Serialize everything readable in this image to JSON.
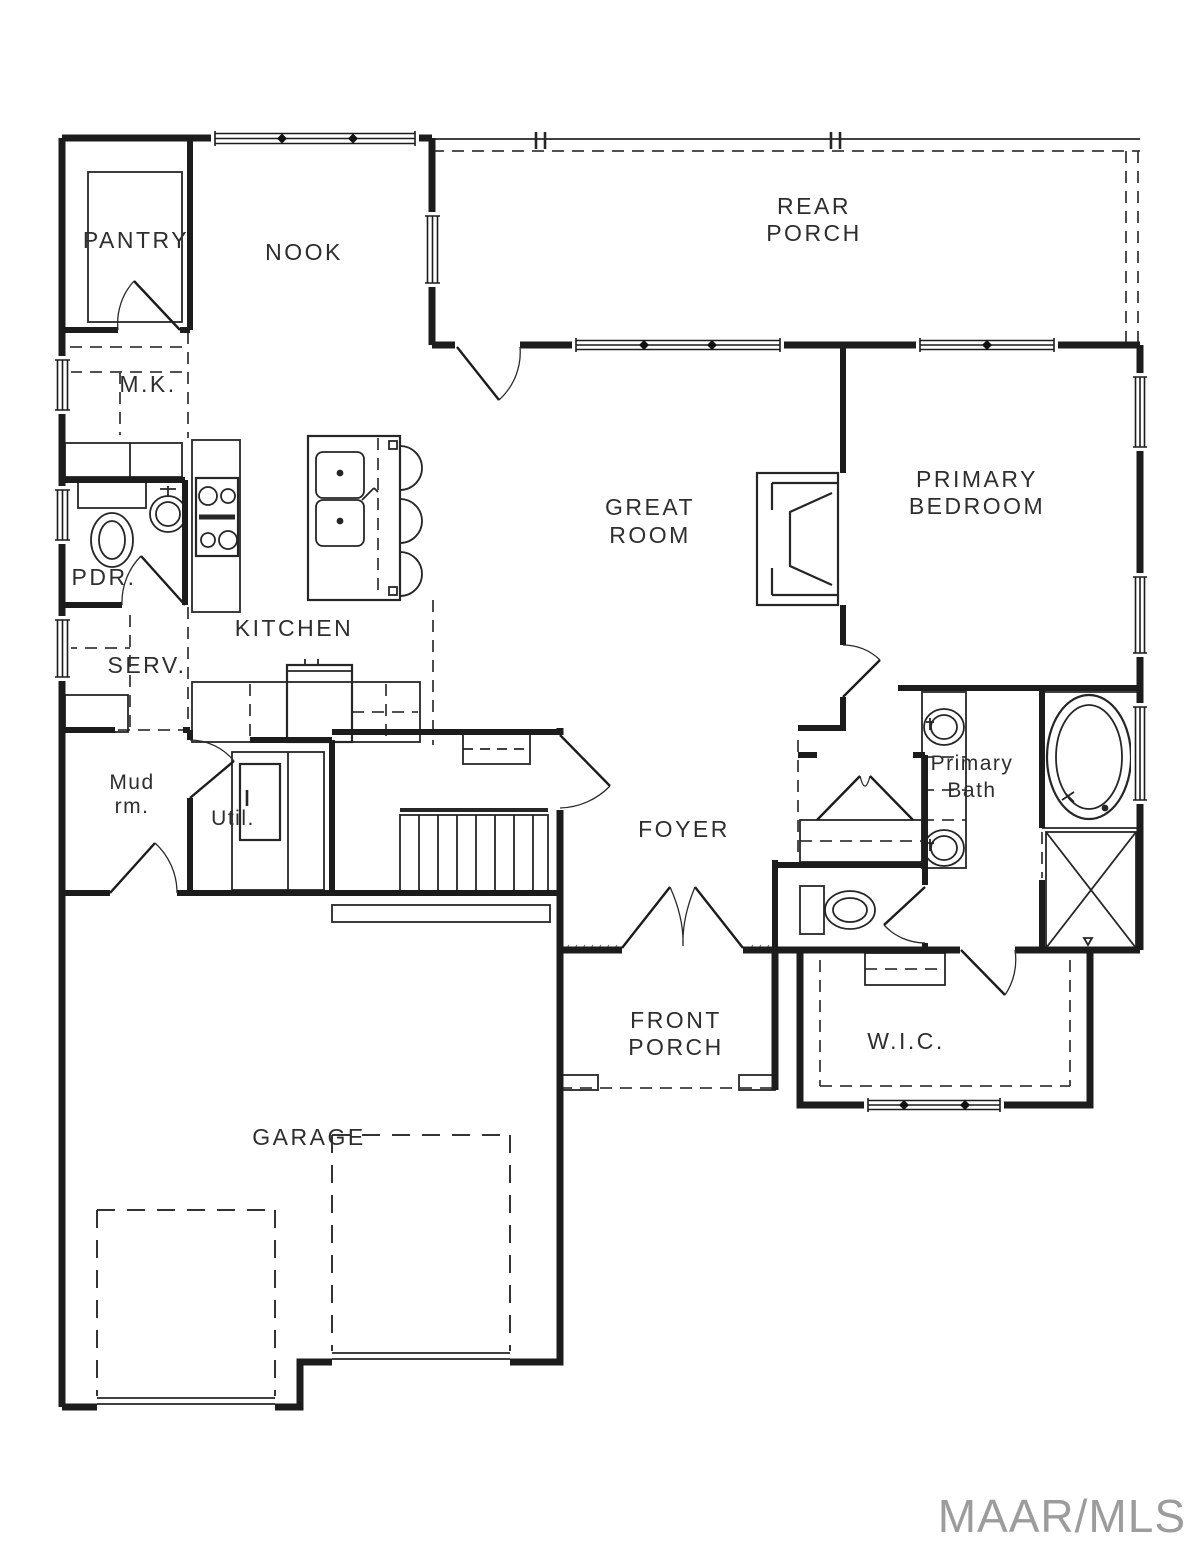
{
  "watermark": "MAAR/MLS",
  "rooms": {
    "pantry": "PANTRY",
    "nook": "NOOK",
    "rear_porch": [
      "REAR",
      "PORCH"
    ],
    "mk": "M.K.",
    "pdr": "PDR.",
    "kitchen": "KITCHEN",
    "serv": "SERV.",
    "great_room": [
      "GREAT",
      "ROOM"
    ],
    "primary_bedroom": [
      "PRIMARY",
      "BEDROOM"
    ],
    "mud_room": [
      "Mud",
      "rm."
    ],
    "util": "Util.",
    "foyer": "FOYER",
    "primary_bath": [
      "Primary",
      "Bath"
    ],
    "front_porch": [
      "FRONT",
      "PORCH"
    ],
    "wic": "W.I.C.",
    "garage": "GARAGE"
  }
}
